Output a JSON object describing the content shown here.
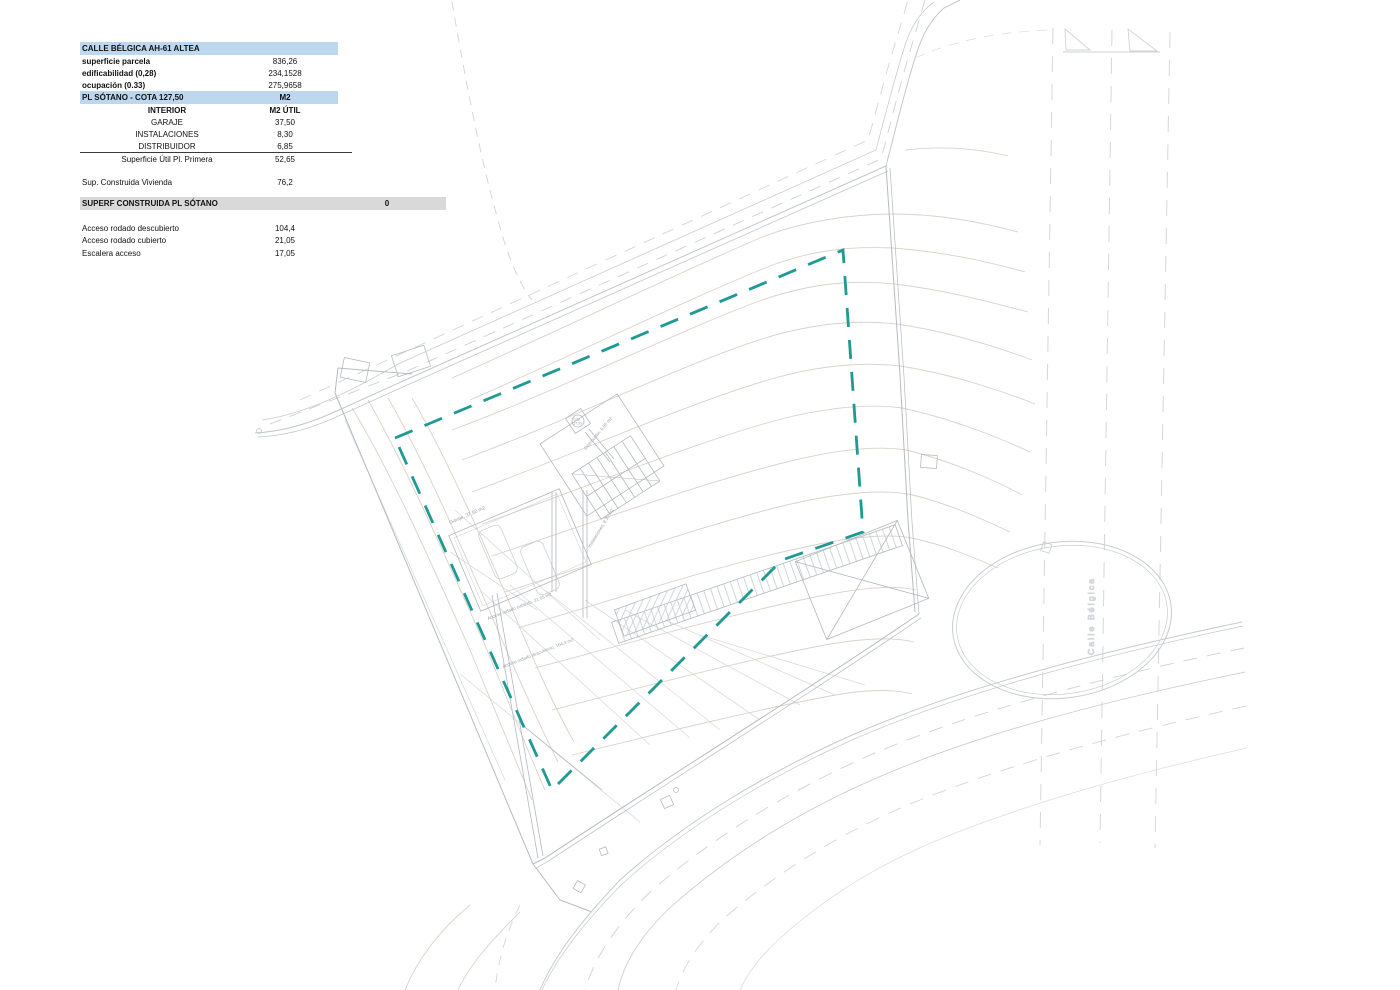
{
  "table": {
    "rows": [
      {
        "label": "CALLE BÉLGICA AH-61 ALTEA",
        "value": ""
      },
      {
        "label": "superficie parcela",
        "value": "836,26"
      },
      {
        "label": "edificabilidad (0,28)",
        "value": "234,1528"
      },
      {
        "label": "ocupación (0.33)",
        "value": "275,9658"
      },
      {
        "label": "PL SÓTANO - COTA 127,50",
        "value": "M2"
      },
      {
        "label": "INTERIOR",
        "value": "M2 ÚTIL"
      },
      {
        "label": "GARAJE",
        "value": "37,50"
      },
      {
        "label": "INSTALACIONES",
        "value": "8,30"
      },
      {
        "label": "DISTRIBUIDOR",
        "value": "6,85"
      },
      {
        "label": "Superficie Útil Pl. Primera",
        "value": "52,65"
      },
      {
        "label": "Sup. Construida Vivienda",
        "value": "76,2"
      },
      {
        "label": "SUPERF CONSTRUIDA PL SÓTANO",
        "value": "0"
      },
      {
        "label": "Acceso rodado descubierto",
        "value": "104,4"
      },
      {
        "label": "Acceso rodado cubierto",
        "value": "21,05"
      },
      {
        "label": "Escalera acceso",
        "value": "17,05"
      }
    ]
  },
  "plan": {
    "street_label": "Calle Bélgica",
    "labels": {
      "garage": "Garaje, 37,50 m2",
      "installations": "Instalaciones, 8,30 m2",
      "distributor": "Distribuidor, 6,85 m2",
      "cota_top": "Cota",
      "cota_bottom": "127,50",
      "access_covered": "Acceso rodado cubierto, 21,05 m2",
      "access_open": "Acceso rodado descubierto, 104,4 m2"
    },
    "colors": {
      "setback_teal": "#1d9a93",
      "line_gray": "#c3c7cb",
      "boundary_gray": "#b7bbc0",
      "contour_tan": "#d9cdc0",
      "header_blue": "#bdd7ee",
      "header_gray": "#d9d9d9"
    }
  }
}
